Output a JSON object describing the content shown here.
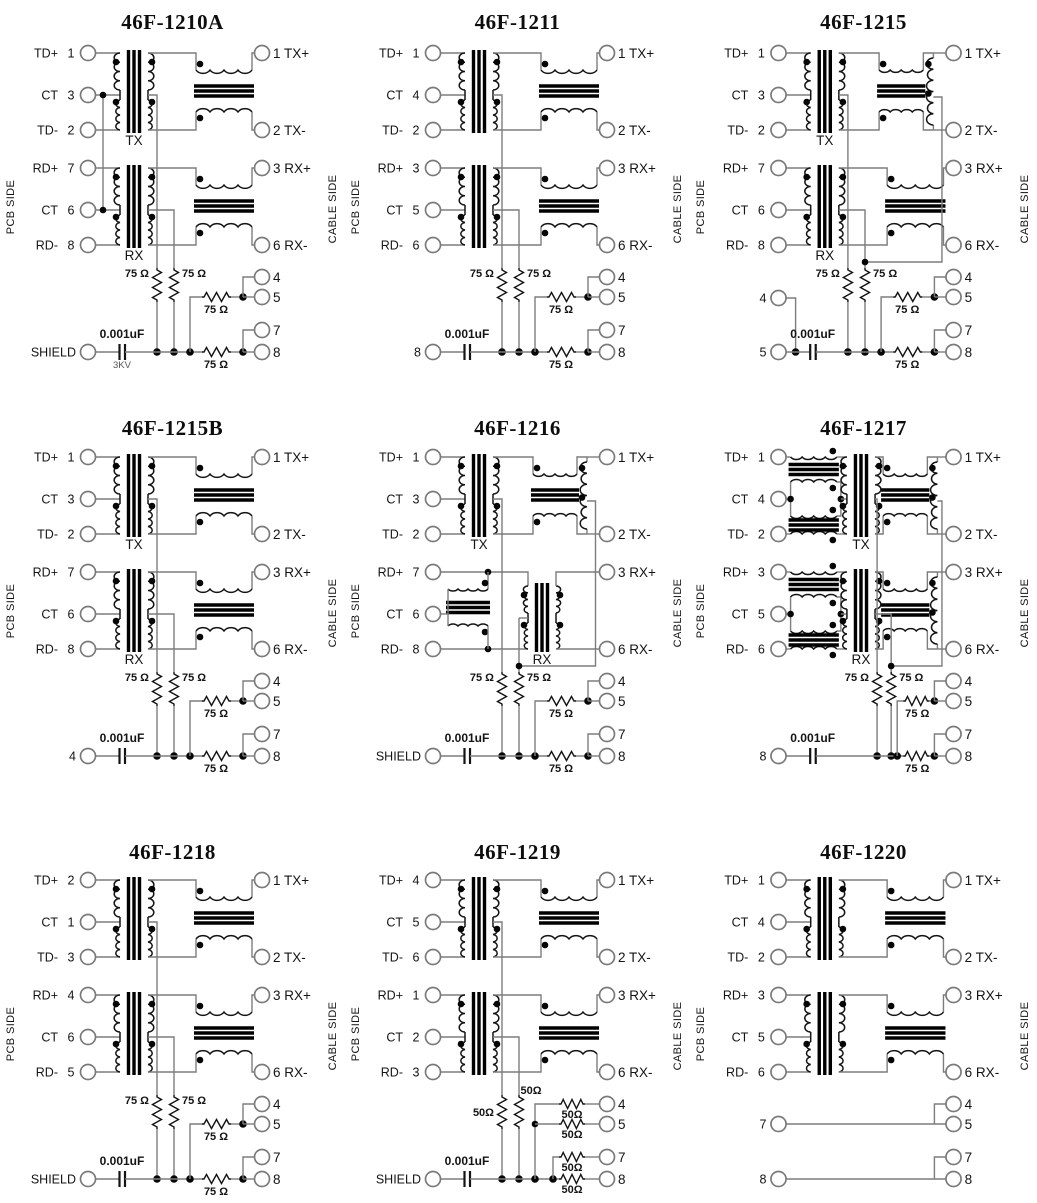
{
  "page": {
    "background": "#ffffff",
    "wire_color": "#7d7d7d",
    "component_color": "#141414"
  },
  "schematics": [
    {
      "title": "46F-1210A",
      "sides": {
        "left": "PCB SIDE",
        "right": "CABLE SIDE"
      },
      "left_pins": [
        {
          "label": "TD+",
          "num": "1"
        },
        {
          "label": "CT",
          "num": "3"
        },
        {
          "label": "TD-",
          "num": "2"
        },
        {
          "label": "RD+",
          "num": "7"
        },
        {
          "label": "CT",
          "num": "6"
        },
        {
          "label": "RD-",
          "num": "8"
        }
      ],
      "right_pins": [
        "1 TX+",
        "2 TX-",
        "3 RX+",
        "6 RX-",
        "4",
        "5",
        "7",
        "8"
      ],
      "bottom_pins": [
        {
          "label": "SHIELD",
          "pos": "rail"
        }
      ],
      "tx_label": "TX",
      "rx_label": "RX",
      "components": {
        "res_v": [
          "75 Ω",
          "75 Ω"
        ],
        "res_h": [
          "75 Ω",
          "75 Ω"
        ],
        "cap": "0.001uF",
        "cap_note": "3KV"
      },
      "topology": {
        "tx": "std",
        "rx": "std",
        "ct_link": true,
        "right_drop": false,
        "network": "std"
      }
    },
    {
      "title": "46F-1211",
      "sides": {
        "left": "PCB SIDE",
        "right": "CABLE SIDE"
      },
      "left_pins": [
        {
          "label": "TD+",
          "num": "1"
        },
        {
          "label": "CT",
          "num": "4"
        },
        {
          "label": "TD-",
          "num": "2"
        },
        {
          "label": "RD+",
          "num": "3"
        },
        {
          "label": "CT",
          "num": "5"
        },
        {
          "label": "RD-",
          "num": "6"
        }
      ],
      "right_pins": [
        "1 TX+",
        "2 TX-",
        "3 RX+",
        "6 RX-",
        "4",
        "5",
        "7",
        "8"
      ],
      "bottom_pins": [
        {
          "label": "8",
          "pos": "rail"
        }
      ],
      "tx_label": null,
      "rx_label": null,
      "components": {
        "res_v": [
          "75 Ω",
          "75 Ω"
        ],
        "res_h": [
          "75 Ω",
          "75 Ω"
        ],
        "cap": "0.001uF",
        "cap_note": null
      },
      "topology": {
        "tx": "std",
        "rx": "std",
        "ct_link": false,
        "right_drop": false,
        "network": "std"
      }
    },
    {
      "title": "46F-1215",
      "sides": {
        "left": "PCB SIDE",
        "right": "CABLE SIDE"
      },
      "left_pins": [
        {
          "label": "TD+",
          "num": "1"
        },
        {
          "label": "CT",
          "num": "3"
        },
        {
          "label": "TD-",
          "num": "2"
        },
        {
          "label": "RD+",
          "num": "7"
        },
        {
          "label": "CT",
          "num": "6"
        },
        {
          "label": "RD-",
          "num": "8"
        }
      ],
      "right_pins": [
        "1 TX+",
        "2 TX-",
        "3 RX+",
        "6 RX-",
        "4",
        "5",
        "7",
        "8"
      ],
      "bottom_pins": [
        {
          "label": "4",
          "pos": "upper"
        },
        {
          "label": "5",
          "pos": "rail"
        }
      ],
      "tx_label": "TX",
      "rx_label": "RX",
      "components": {
        "res_v": [
          "75 Ω",
          "75 Ω"
        ],
        "res_h": [
          "75 Ω",
          "75 Ω"
        ],
        "cap": "0.001uF",
        "cap_note": null
      },
      "topology": {
        "tx": "std+v",
        "rx": "std",
        "ct_link": false,
        "right_drop": true,
        "network": "std"
      }
    },
    {
      "title": "46F-1215B",
      "sides": {
        "left": "PCB SIDE",
        "right": "CABLE SIDE"
      },
      "left_pins": [
        {
          "label": "TD+",
          "num": "1"
        },
        {
          "label": "CT",
          "num": "3"
        },
        {
          "label": "TD-",
          "num": "2"
        },
        {
          "label": "RD+",
          "num": "7"
        },
        {
          "label": "CT",
          "num": "6"
        },
        {
          "label": "RD-",
          "num": "8"
        }
      ],
      "right_pins": [
        "1 TX+",
        "2 TX-",
        "3 RX+",
        "6 RX-",
        "4",
        "5",
        "7",
        "8"
      ],
      "bottom_pins": [
        {
          "label": "4",
          "pos": "rail"
        }
      ],
      "tx_label": "TX",
      "rx_label": "RX",
      "components": {
        "res_v": [
          "75 Ω",
          "75 Ω"
        ],
        "res_h": [
          "75 Ω",
          "75 Ω"
        ],
        "cap": "0.001uF",
        "cap_note": null
      },
      "topology": {
        "tx": "std",
        "rx": "std",
        "ct_link": false,
        "right_drop": false,
        "network": "std"
      }
    },
    {
      "title": "46F-1216",
      "sides": {
        "left": "PCB SIDE",
        "right": "CABLE SIDE"
      },
      "left_pins": [
        {
          "label": "TD+",
          "num": "1"
        },
        {
          "label": "CT",
          "num": "3"
        },
        {
          "label": "TD-",
          "num": "2"
        },
        {
          "label": "RD+",
          "num": "7"
        },
        {
          "label": "CT",
          "num": "6"
        },
        {
          "label": "RD-",
          "num": "8"
        }
      ],
      "right_pins": [
        "1 TX+",
        "2 TX-",
        "3 RX+",
        "6 RX-",
        "4",
        "5",
        "7",
        "8"
      ],
      "bottom_pins": [
        {
          "label": "SHIELD",
          "pos": "rail"
        }
      ],
      "tx_label": "TX",
      "rx_label": "RX",
      "components": {
        "res_v": [
          "75 Ω",
          "75 Ω"
        ],
        "res_h": [
          "75 Ω",
          "75 Ω"
        ],
        "cap": "0.001uF",
        "cap_note": null
      },
      "topology": {
        "tx": "std+v",
        "rx": "choke-left",
        "ct_link": false,
        "right_drop": true,
        "network": "std"
      }
    },
    {
      "title": "46F-1217",
      "sides": {
        "left": "PCB SIDE",
        "right": "CABLE SIDE"
      },
      "left_pins": [
        {
          "label": "TD+",
          "num": "1"
        },
        {
          "label": "CT",
          "num": "4"
        },
        {
          "label": "TD-",
          "num": "2"
        },
        {
          "label": "RD+",
          "num": "3"
        },
        {
          "label": "CT",
          "num": "5"
        },
        {
          "label": "RD-",
          "num": "6"
        }
      ],
      "right_pins": [
        "1 TX+",
        "2 TX-",
        "3 RX+",
        "6 RX-",
        "4",
        "5",
        "7",
        "8"
      ],
      "bottom_pins": [
        {
          "label": "8",
          "pos": "rail"
        }
      ],
      "tx_label": "TX",
      "rx_label": "RX",
      "components": {
        "res_v": [
          "75 Ω",
          "75 Ω"
        ],
        "res_h": [
          "75 Ω",
          "75 Ω"
        ],
        "cap": "0.001uF",
        "cap_note": null
      },
      "topology": {
        "tx": "chokes+v",
        "rx": "chokes+v",
        "ct_link": false,
        "right_drop": true,
        "network": "std17"
      }
    },
    {
      "title": "46F-1218",
      "sides": {
        "left": "PCB SIDE",
        "right": "CABLE SIDE"
      },
      "left_pins": [
        {
          "label": "TD+",
          "num": "2"
        },
        {
          "label": "CT",
          "num": "1"
        },
        {
          "label": "TD-",
          "num": "3"
        },
        {
          "label": "RD+",
          "num": "4"
        },
        {
          "label": "CT",
          "num": "6"
        },
        {
          "label": "RD-",
          "num": "5"
        }
      ],
      "right_pins": [
        "1 TX+",
        "2 TX-",
        "3 RX+",
        "6 RX-",
        "4",
        "5",
        "7",
        "8"
      ],
      "bottom_pins": [
        {
          "label": "SHIELD",
          "pos": "rail"
        }
      ],
      "tx_label": null,
      "rx_label": null,
      "components": {
        "res_v": [
          "75 Ω",
          "75 Ω"
        ],
        "res_h": [
          "75 Ω",
          "75 Ω"
        ],
        "cap": "0.001uF",
        "cap_note": null
      },
      "topology": {
        "tx": "std",
        "rx": "std",
        "ct_link": false,
        "right_drop": false,
        "network": "std"
      }
    },
    {
      "title": "46F-1219",
      "sides": {
        "left": "PCB SIDE",
        "right": "CABLE SIDE"
      },
      "left_pins": [
        {
          "label": "TD+",
          "num": "4"
        },
        {
          "label": "CT",
          "num": "5"
        },
        {
          "label": "TD-",
          "num": "6"
        },
        {
          "label": "RD+",
          "num": "1"
        },
        {
          "label": "CT",
          "num": "2"
        },
        {
          "label": "RD-",
          "num": "3"
        }
      ],
      "right_pins": [
        "1 TX+",
        "2 TX-",
        "3 RX+",
        "6 RX-",
        "4",
        "5",
        "7",
        "8"
      ],
      "bottom_pins": [
        {
          "label": "SHIELD",
          "pos": "rail"
        }
      ],
      "tx_label": null,
      "rx_label": null,
      "components": {
        "res_v": [
          "50Ω",
          "50Ω"
        ],
        "res_h": [
          "50Ω",
          "50Ω",
          "50Ω",
          "50Ω"
        ],
        "cap": "0.001uF",
        "cap_note": null
      },
      "topology": {
        "tx": "std",
        "rx": "std",
        "ct_link": false,
        "right_drop": false,
        "network": "four"
      }
    },
    {
      "title": "46F-1220",
      "sides": {
        "left": "PCB SIDE",
        "right": "CABLE SIDE"
      },
      "left_pins": [
        {
          "label": "TD+",
          "num": "1"
        },
        {
          "label": "CT",
          "num": "4"
        },
        {
          "label": "TD-",
          "num": "2"
        },
        {
          "label": "RD+",
          "num": "3"
        },
        {
          "label": "CT",
          "num": "5"
        },
        {
          "label": "RD-",
          "num": "6"
        }
      ],
      "right_pins": [
        "1 TX+",
        "2 TX-",
        "3 RX+",
        "6 RX-",
        "4",
        "5",
        "7",
        "8"
      ],
      "bottom_pins": [
        {
          "label": "7",
          "pos": "upper"
        },
        {
          "label": "8",
          "pos": "rail"
        }
      ],
      "tx_label": null,
      "rx_label": null,
      "components": {
        "res_v": [],
        "res_h": [],
        "cap": null,
        "cap_note": null
      },
      "topology": {
        "tx": "std",
        "rx": "std",
        "ct_link": false,
        "right_drop": false,
        "network": "direct"
      }
    }
  ]
}
